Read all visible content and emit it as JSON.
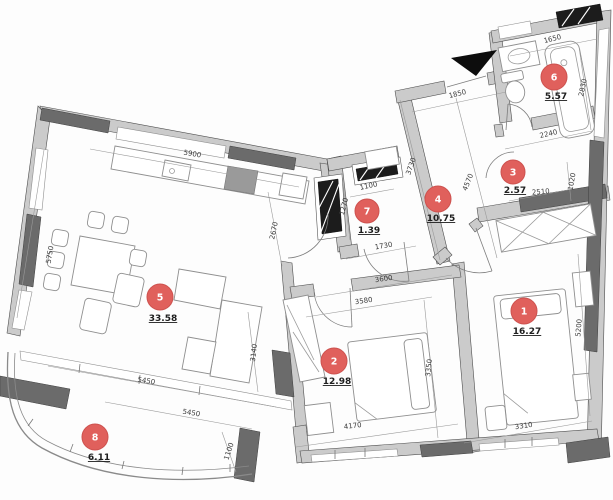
{
  "plan": {
    "badge_color": "#e0605c",
    "badge_ring": "#cd514e",
    "rooms": [
      {
        "num": "1",
        "area": "16.27"
      },
      {
        "num": "2",
        "area": "12.98"
      },
      {
        "num": "3",
        "area": "2.57"
      },
      {
        "num": "4",
        "area": "10.75"
      },
      {
        "num": "5",
        "area": "33.58"
      },
      {
        "num": "6",
        "area": "5.57"
      },
      {
        "num": "7",
        "area": "1.39"
      },
      {
        "num": "8",
        "area": "6.11"
      }
    ],
    "dims": [
      "1650",
      "2830",
      "2240",
      "2510",
      "1020",
      "4570",
      "1850",
      "3730",
      "1100",
      "1270",
      "1730",
      "2670",
      "3600",
      "3580",
      "4170",
      "3350",
      "3310",
      "5200",
      "5900",
      "5750",
      "5450",
      "5450",
      "3140",
      "1100"
    ]
  }
}
